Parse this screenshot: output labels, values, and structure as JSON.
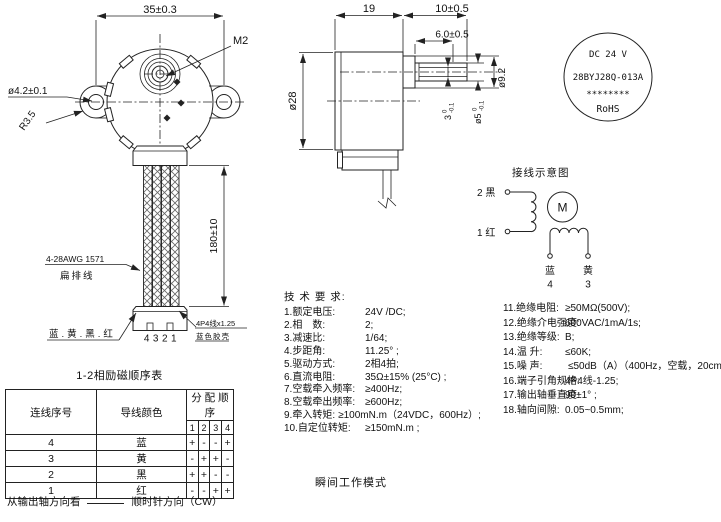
{
  "front_view": {
    "dim_width": "35±0.3",
    "thread_label": "M2",
    "hole_dia": "ø4.2±0.1",
    "ear_radius": "R3.5",
    "lead_length": "180±10",
    "wire_spec": "4-28AWG 1571",
    "wire_type": "扁排线",
    "wire_colors": "蓝.黄.黑.红",
    "pin_numbers": "4321",
    "connector_spec": "4P4线x1.25",
    "connector_shell": "蓝色胶壳"
  },
  "side_view": {
    "dim_depth": "19",
    "dim_shaft_total": "10±0.5",
    "dim_flat_len": "6.0±0.5",
    "dim_body_dia": "ø28",
    "dim_boss_dia": "ø9.2",
    "dim_flat": {
      "val": "3",
      "tol_up": "0",
      "tol_dn": "-0.1"
    },
    "dim_shaft_dia": {
      "val": "ø5",
      "tol_up": "0",
      "tol_dn": "-0.1"
    }
  },
  "nameplate": {
    "voltage": "DC 24 V",
    "model": "28BYJ28Q-013A",
    "stars": "********",
    "rohs": "RoHS"
  },
  "wiring": {
    "title": "接线示意图",
    "terminal2": "2 黑",
    "terminal1": "1 红",
    "motor_symbol": "M",
    "blue_label": "蓝",
    "blue_num": "4",
    "yellow_label": "黄",
    "yellow_num": "3"
  },
  "tech": {
    "heading": "技 术 要 求:",
    "left": [
      {
        "label": "1.额定电压:",
        "value": "24V /DC;"
      },
      {
        "label": "2.相　数:",
        "value": "2;"
      },
      {
        "label": "3.减速比:",
        "value": "1/64;"
      },
      {
        "label": "4.步距角:",
        "value": "11.25° ;"
      },
      {
        "label": "5.驱动方式:",
        "value": "2相4拍;"
      },
      {
        "label": "6.直流电阻:",
        "value": "35Ω±15% (25°C) ;"
      },
      {
        "label": "7.空载牵入频率:",
        "value": "≥400Hz;"
      },
      {
        "label": "8.空载牵出频率:",
        "value": "≥600Hz;"
      },
      {
        "label": "9.牵入转矩:",
        "value": "≥100mN.m（24VDC，600Hz）;"
      },
      {
        "label": "10.自定位转矩:",
        "value": "≥150mN.m ;"
      }
    ],
    "right": [
      {
        "label": "11.绝缘电阻:",
        "value": "≥50MΩ(500V);"
      },
      {
        "label": "12.绝缘介电强度:",
        "value": "600VAC/1mA/1s;"
      },
      {
        "label": "13.绝缘等级:",
        "value": "B;"
      },
      {
        "label": "14.温 升:",
        "value": "≤60K;"
      },
      {
        "label": "15.噪 声:",
        "value": "≤50dB（A）（400Hz，空载，20cm）;"
      },
      {
        "label": "16.端子引角规格:",
        "value": "4P4线-1.25;"
      },
      {
        "label": "17.输出轴垂直度:",
        "value": "90±1° ;"
      },
      {
        "label": "18.轴向间隙:",
        "value": "0.05~0.5mm;"
      }
    ],
    "mode": "瞬间工作模式"
  },
  "table": {
    "title": "1-2相励磁顺序表",
    "col_wire": "连线序号",
    "col_color": "导线颜色",
    "col_order": "分 配 顺 序",
    "order_steps": [
      "1",
      "2",
      "3",
      "4"
    ],
    "rows": [
      {
        "num": "4",
        "color": "蓝",
        "steps": [
          "+",
          "-",
          "-",
          "+"
        ]
      },
      {
        "num": "3",
        "color": "黄",
        "steps": [
          "-",
          "+",
          "+",
          "-"
        ]
      },
      {
        "num": "2",
        "color": "黑",
        "steps": [
          "+",
          "+",
          "-",
          "-"
        ]
      },
      {
        "num": "1",
        "color": "红",
        "steps": [
          "-",
          "-",
          "+",
          "+"
        ]
      }
    ],
    "note_view": "从输出轴方向看",
    "note_dir": "顺时针方向（CW）"
  }
}
